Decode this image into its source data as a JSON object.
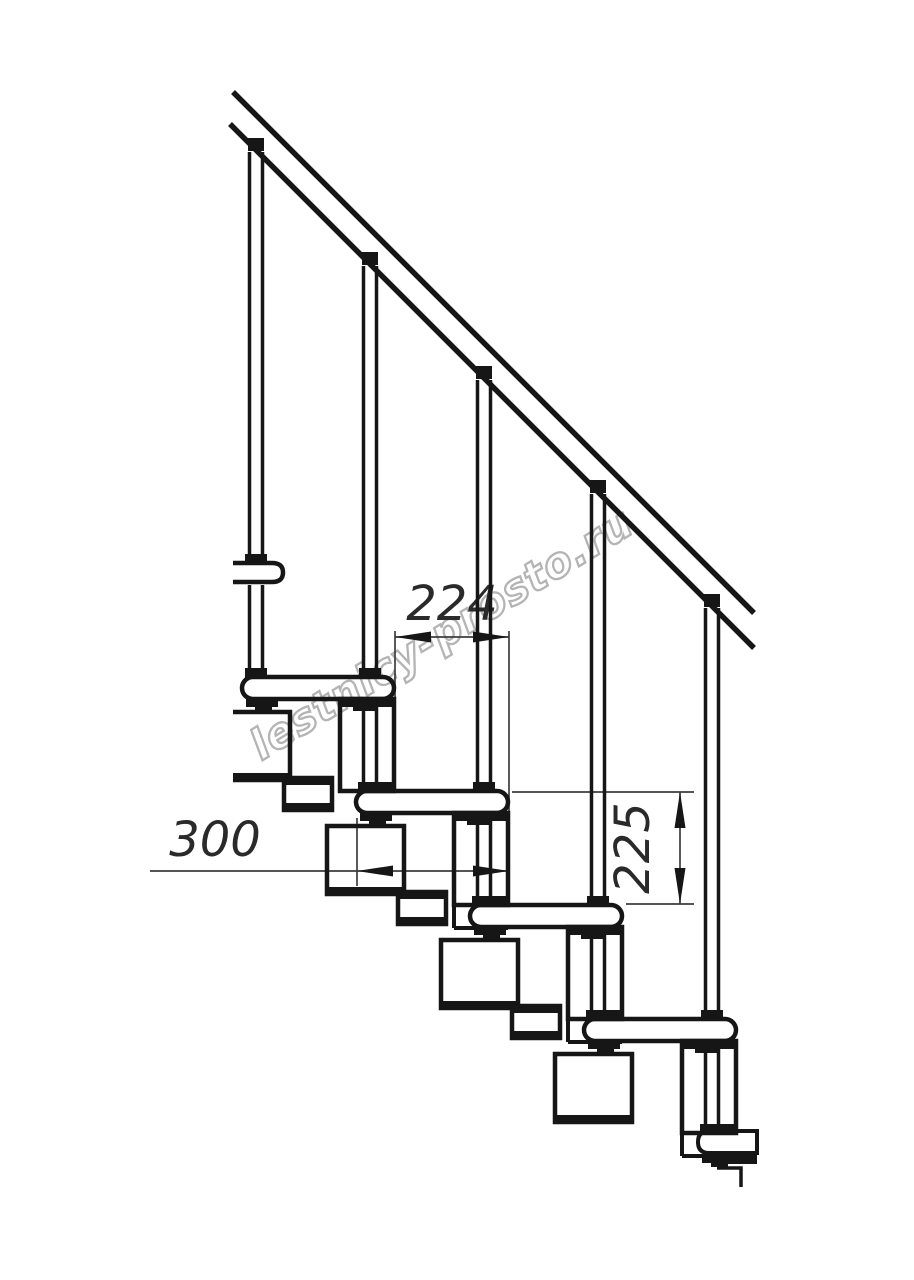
{
  "drawing": {
    "watermark_text": "lestnicy-prosto.ru",
    "dimension_labels": {
      "step_run": "224",
      "tread_depth": "300",
      "step_rise": "225"
    },
    "colors": {
      "background": "#ffffff",
      "line": "#161616",
      "dimension_line": "#3d3d3d",
      "dimension_text": "#2a2a2a",
      "watermark": "#b4b4b4"
    }
  }
}
